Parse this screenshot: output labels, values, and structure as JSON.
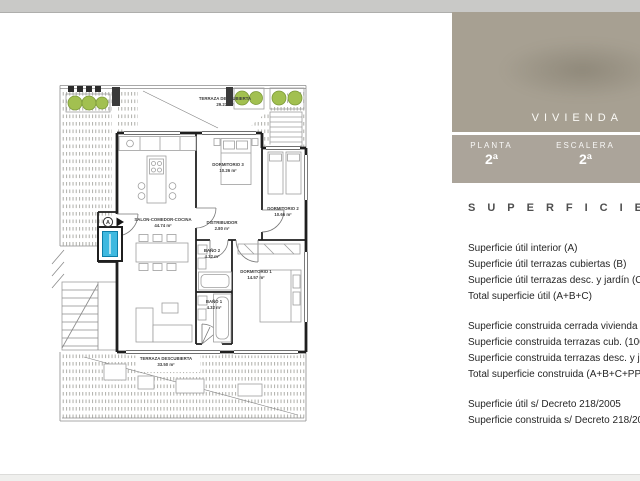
{
  "panel": {
    "vivienda_label": "VIVIENDA",
    "planta_label": "PLANTA",
    "planta_value": "2ª",
    "escalera_label": "ESCALERA",
    "escalera_value": "2ª",
    "superficies_heading": "SUPERFICIES",
    "groups": [
      {
        "lines": [
          "Superficie útil interior (A)",
          "Superficie útil terrazas cubiertas (B)",
          "Superficie útil terrazas desc. y jardín (C)",
          "Total superficie útil (A+B+C)"
        ]
      },
      {
        "lines": [
          "Superficie construida cerrada vivienda (A)",
          "Superficie construida terrazas cub. (100%) (B)",
          "Superficie construida terrazas desc. y jardín (C)",
          "Total superficie construida (A+B+C+PPZC)"
        ]
      },
      {
        "lines": [
          "Superficie útil s/ Decreto 218/2005",
          "Superficie construida s/ Decreto 218/2005"
        ]
      }
    ]
  },
  "floorplan": {
    "entrance_marker": "A",
    "rooms": [
      {
        "name": "TERRAZA DESCUBIERTA",
        "area": "29.23 m²"
      },
      {
        "name": "SALON-COMEDOR-COCINA",
        "area": "44.74 m²"
      },
      {
        "name": "DORMITORIO 3",
        "area": "10.26 m²"
      },
      {
        "name": "DISTRIBUIDOR",
        "area": "2.80 m²"
      },
      {
        "name": "DORMITORIO 2",
        "area": "10.66 m²"
      },
      {
        "name": "BAÑO 2",
        "area": "4.32 m²"
      },
      {
        "name": "DORMITORIO 1",
        "area": "14.57 m²"
      },
      {
        "name": "BAÑO 1",
        "area": "4.32 m²"
      },
      {
        "name": "TERRAZA DESCUBIERTA",
        "area": "33.50 m²"
      }
    ],
    "colors": {
      "elevator_blue": "#3fb9e0",
      "plant_green": "#a2c050",
      "panel_beige": "#a7a092"
    }
  }
}
